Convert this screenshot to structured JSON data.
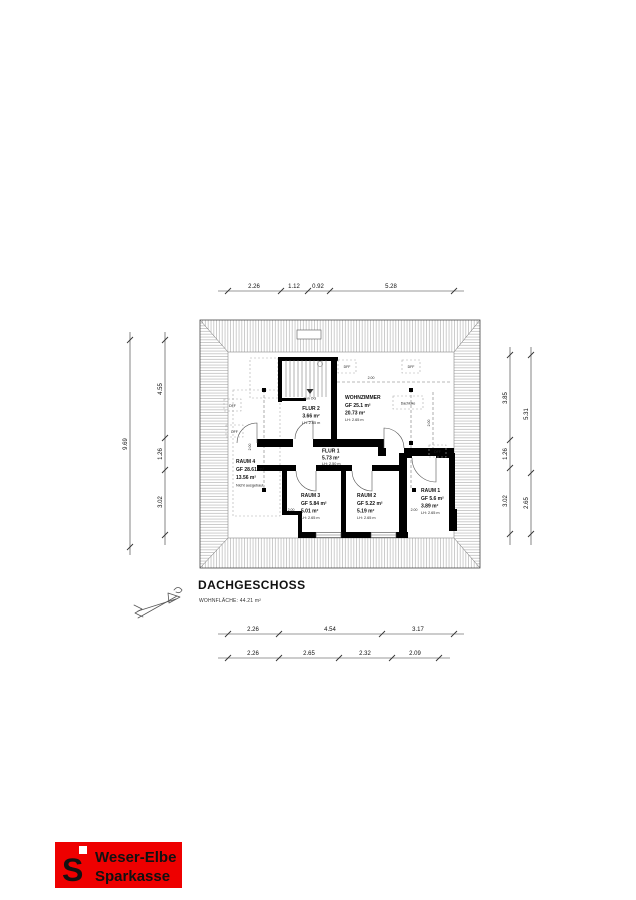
{
  "title": {
    "text": "DACHGESCHOSS",
    "subtitle": "WOHNFLÄCHE: 44.21 m²"
  },
  "rooms": {
    "flur2": {
      "name": "FLUR 2",
      "line2": "3.66 m²",
      "line3": "LH: 2.65 m"
    },
    "wohnzimmer": {
      "name": "WOHNZIMMER",
      "line2": "GF 25.1 m²",
      "line3": "20.73 m²",
      "line4": "LH: 2.65 m"
    },
    "flur1": {
      "name": "FLUR 1",
      "line2": "5.73 m²",
      "line3": "LH: 2.50 m"
    },
    "raum4": {
      "name": "RAUM 4",
      "line2": "GF 28.61 m²",
      "line3": "13.56 m²",
      "line4": "Nicht ausgebaut"
    },
    "raum3": {
      "name": "RAUM 3",
      "line2": "GF 5.84 m²",
      "line3": "5.01 m²",
      "line4": "LH: 2.65 m"
    },
    "raum2": {
      "name": "RAUM 2",
      "line2": "GF 5.22 m²",
      "line3": "5.19 m²",
      "line4": "LH: 2.65 m"
    },
    "raum1": {
      "name": "RAUM 1",
      "line2": "GF 5.6 m²",
      "line3": "3.89 m²",
      "line4": "LH: 2.65 m"
    }
  },
  "annotations": {
    "stair": "Von OG",
    "hatch_opening": "Dachluke",
    "roof_window": "DFF",
    "height_mark": "2.00"
  },
  "dimensions": {
    "top": [
      "2.26",
      "1.12",
      "0.92",
      "5.28"
    ],
    "bottom_row1": [
      "2.26",
      "4.54",
      "3.17"
    ],
    "bottom_row2": [
      "2.26",
      "2.65",
      "2.32",
      "2.09"
    ],
    "left_outer": [
      "9.69"
    ],
    "left_inner": [
      "4.55",
      "1.26",
      "3.02"
    ],
    "right_inner": [
      "3.85",
      "1.26",
      "3.02"
    ],
    "right_outer": [
      "5.31",
      "2.65"
    ]
  },
  "logo": {
    "symbol": "S",
    "line1": "Weser-Elbe",
    "line2": "Sparkasse",
    "background": "#ee0000",
    "text_color": "#ffffff"
  }
}
